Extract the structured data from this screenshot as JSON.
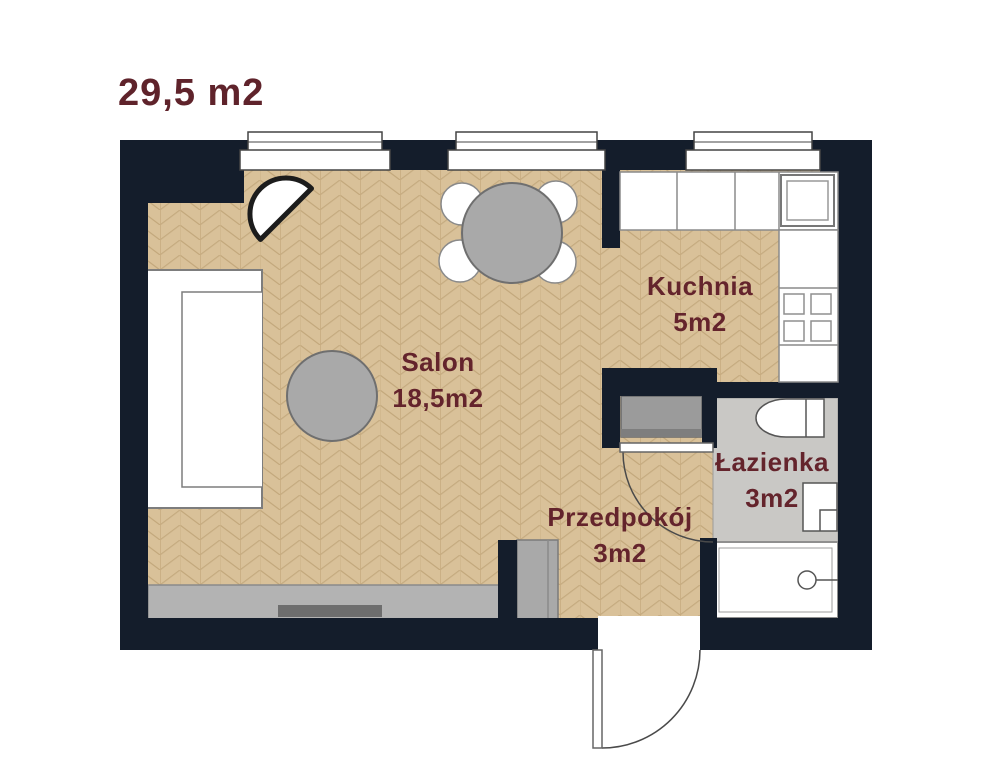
{
  "title": "29,5 m2",
  "rooms": [
    {
      "id": "salon",
      "label": "Salon",
      "area": "18,5m2"
    },
    {
      "id": "kuchnia",
      "label": "Kuchnia",
      "area": "5m2"
    },
    {
      "id": "przedpokoj",
      "label": "Przedpokój",
      "area": "3m2"
    },
    {
      "id": "lazienka",
      "label": "Łazienka",
      "area": "3m2"
    }
  ],
  "colors": {
    "wall": "#141d2b",
    "wood_floor": "#d9c199",
    "wood_seam": "#c3a87c",
    "bathroom_floor": "#c9c8c5",
    "furniture_gray": "#a9a9a9",
    "accent_text": "#5f232b",
    "fixture_white": "#ffffff"
  }
}
